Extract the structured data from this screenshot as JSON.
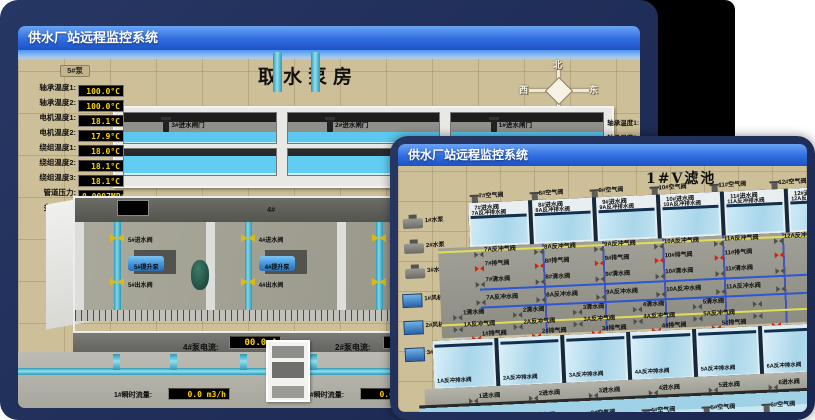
{
  "back_window": {
    "title": "供水厂站远程监控系统",
    "scene_title": "取水泵房",
    "compass": {
      "n": "北",
      "s": "南",
      "w": "西",
      "e": "东"
    },
    "pump_panel": {
      "header": "5#泵",
      "rows": [
        {
          "label": "轴承温度1:",
          "value": "100.0°C"
        },
        {
          "label": "轴承温度2:",
          "value": "100.0°C"
        },
        {
          "label": "电机温度1:",
          "value": "18.1°C"
        },
        {
          "label": "电机温度2:",
          "value": "17.9°C"
        },
        {
          "label": "绕组温度1:",
          "value": "18.0°C"
        },
        {
          "label": "绕组温度2:",
          "value": "18.1°C"
        },
        {
          "label": "绕组温度3:",
          "value": "18.1°C"
        },
        {
          "label": "管道压力:",
          "value": "0.0007MPa"
        },
        {
          "label": "多功能阀:",
          "value": "0%"
        }
      ]
    },
    "right_panel_labels": [
      "轴承温度1:",
      "轴承温度2:"
    ],
    "gates": [
      {
        "label": "3#进水闸门"
      },
      {
        "label": "2#进水闸门"
      },
      {
        "label": "1#进水闸门"
      }
    ],
    "bays": [
      {
        "no": "5#",
        "valve_in": "5#进水阀",
        "pump": "5#提升泵",
        "valve_out": "5#出水阀"
      },
      {
        "no": "4#",
        "valve_in": "4#进水阀",
        "pump": "4#提升泵",
        "valve_out": "4#出水阀"
      },
      {
        "no": "3#",
        "valve_in": "3#进水阀",
        "pump": "3#提升泵",
        "valve_out": "3#出水阀"
      },
      {
        "no": "2#",
        "valve_in": "",
        "pump": "",
        "valve_out": ""
      }
    ],
    "current_readings": [
      {
        "label": "4#泵电流:",
        "value": "00.0 A"
      },
      {
        "label": "2#泵电流:",
        "value": ""
      }
    ],
    "flow_readings": [
      {
        "label": "1#瞬时流量:",
        "value": "0.0 m3/h"
      },
      {
        "label": "1#瞬时流量:",
        "value": "0.0 m3/h"
      }
    ]
  },
  "front_window": {
    "title": "供水厂站远程监控系统",
    "scene_title": "1#V滤池",
    "pumps": [
      "1#水泵",
      "2#水泵",
      "3#水泵"
    ],
    "blowers": [
      "1#风机",
      "2#风机",
      "3#风机"
    ],
    "cells_top": [
      {
        "air": "7#空气阀",
        "inlet": "7#进水阀",
        "drain": "7A反冲排水阀",
        "bw_air": "7A反冲气阀",
        "exhaust": "7#排气阀",
        "clean": "7#清水阀",
        "bw_water": "7A反冲水阀"
      },
      {
        "air": "8#空气阀",
        "inlet": "8#进水阀",
        "drain": "8A反冲排水阀",
        "bw_air": "8A反冲气阀",
        "exhaust": "8#排气阀",
        "clean": "8#清水阀",
        "bw_water": "8A反冲水阀"
      },
      {
        "air": "9#空气阀",
        "inlet": "9#进水阀",
        "drain": "9A反冲排水阀",
        "bw_air": "9A反冲气阀",
        "exhaust": "9#排气阀",
        "clean": "9#清水阀",
        "bw_water": "9A反冲水阀"
      },
      {
        "air": "10#空气阀",
        "inlet": "10#进水阀",
        "drain": "10A反冲排水阀",
        "bw_air": "10A反冲气阀",
        "exhaust": "10#排气阀",
        "clean": "10#清水阀",
        "bw_water": "10A反冲水阀"
      },
      {
        "air": "11#空气阀",
        "inlet": "11#进水阀",
        "drain": "11A反冲排水阀",
        "bw_air": "11A反冲气阀",
        "exhaust": "11#排气阀",
        "clean": "11#清水阀",
        "bw_water": "11A反冲水阀"
      },
      {
        "air": "12#空气阀",
        "inlet": "12#进水阀",
        "drain": "12A反冲排水阀",
        "bw_air": "12A反冲气阀",
        "exhaust": "",
        "clean": "",
        "bw_water": ""
      }
    ],
    "cells_bottom": [
      {
        "clean": "1清水阀",
        "bw_air": "1A反冲气阀",
        "exhaust": "1#排气阀",
        "drain": "1A反冲排水阀",
        "inlet": "1进水阀",
        "air": "1#空气阀"
      },
      {
        "clean": "2清水阀",
        "bw_air": "2A反冲气阀",
        "exhaust": "2#排气阀",
        "drain": "2A反冲排水阀",
        "inlet": "2进水阀",
        "air": "2#空气阀"
      },
      {
        "clean": "3清水阀",
        "bw_air": "3A反冲气阀",
        "exhaust": "3#排气阀",
        "drain": "3A反冲排水阀",
        "inlet": "3进水阀",
        "air": "3#空气阀"
      },
      {
        "clean": "4清水阀",
        "bw_air": "4A反冲气阀",
        "exhaust": "4#排气阀",
        "drain": "4A反冲排水阀",
        "inlet": "4进水阀",
        "air": "4#空气阀"
      },
      {
        "clean": "5清水阀",
        "bw_air": "5A反冲气阀",
        "exhaust": "5#排气阀",
        "drain": "5A反冲排水阀",
        "inlet": "5进水阀",
        "air": "5#空气阀"
      },
      {
        "clean": "",
        "bw_air": "",
        "exhaust": "",
        "drain": "6A反冲排水阀",
        "inlet": "6进水阀",
        "air": "6#空气阀"
      }
    ]
  },
  "colors": {
    "card_navy": "#223160",
    "titlebar_blue": "#2f6de0",
    "ground_tan": "#cdbf98",
    "water_blue": "#5cc8f0",
    "value_yellow": "#ffd400",
    "valve_yellow": "#dcb915",
    "valve_red": "#d42410",
    "pipe_cyan": "#45b7d4"
  }
}
